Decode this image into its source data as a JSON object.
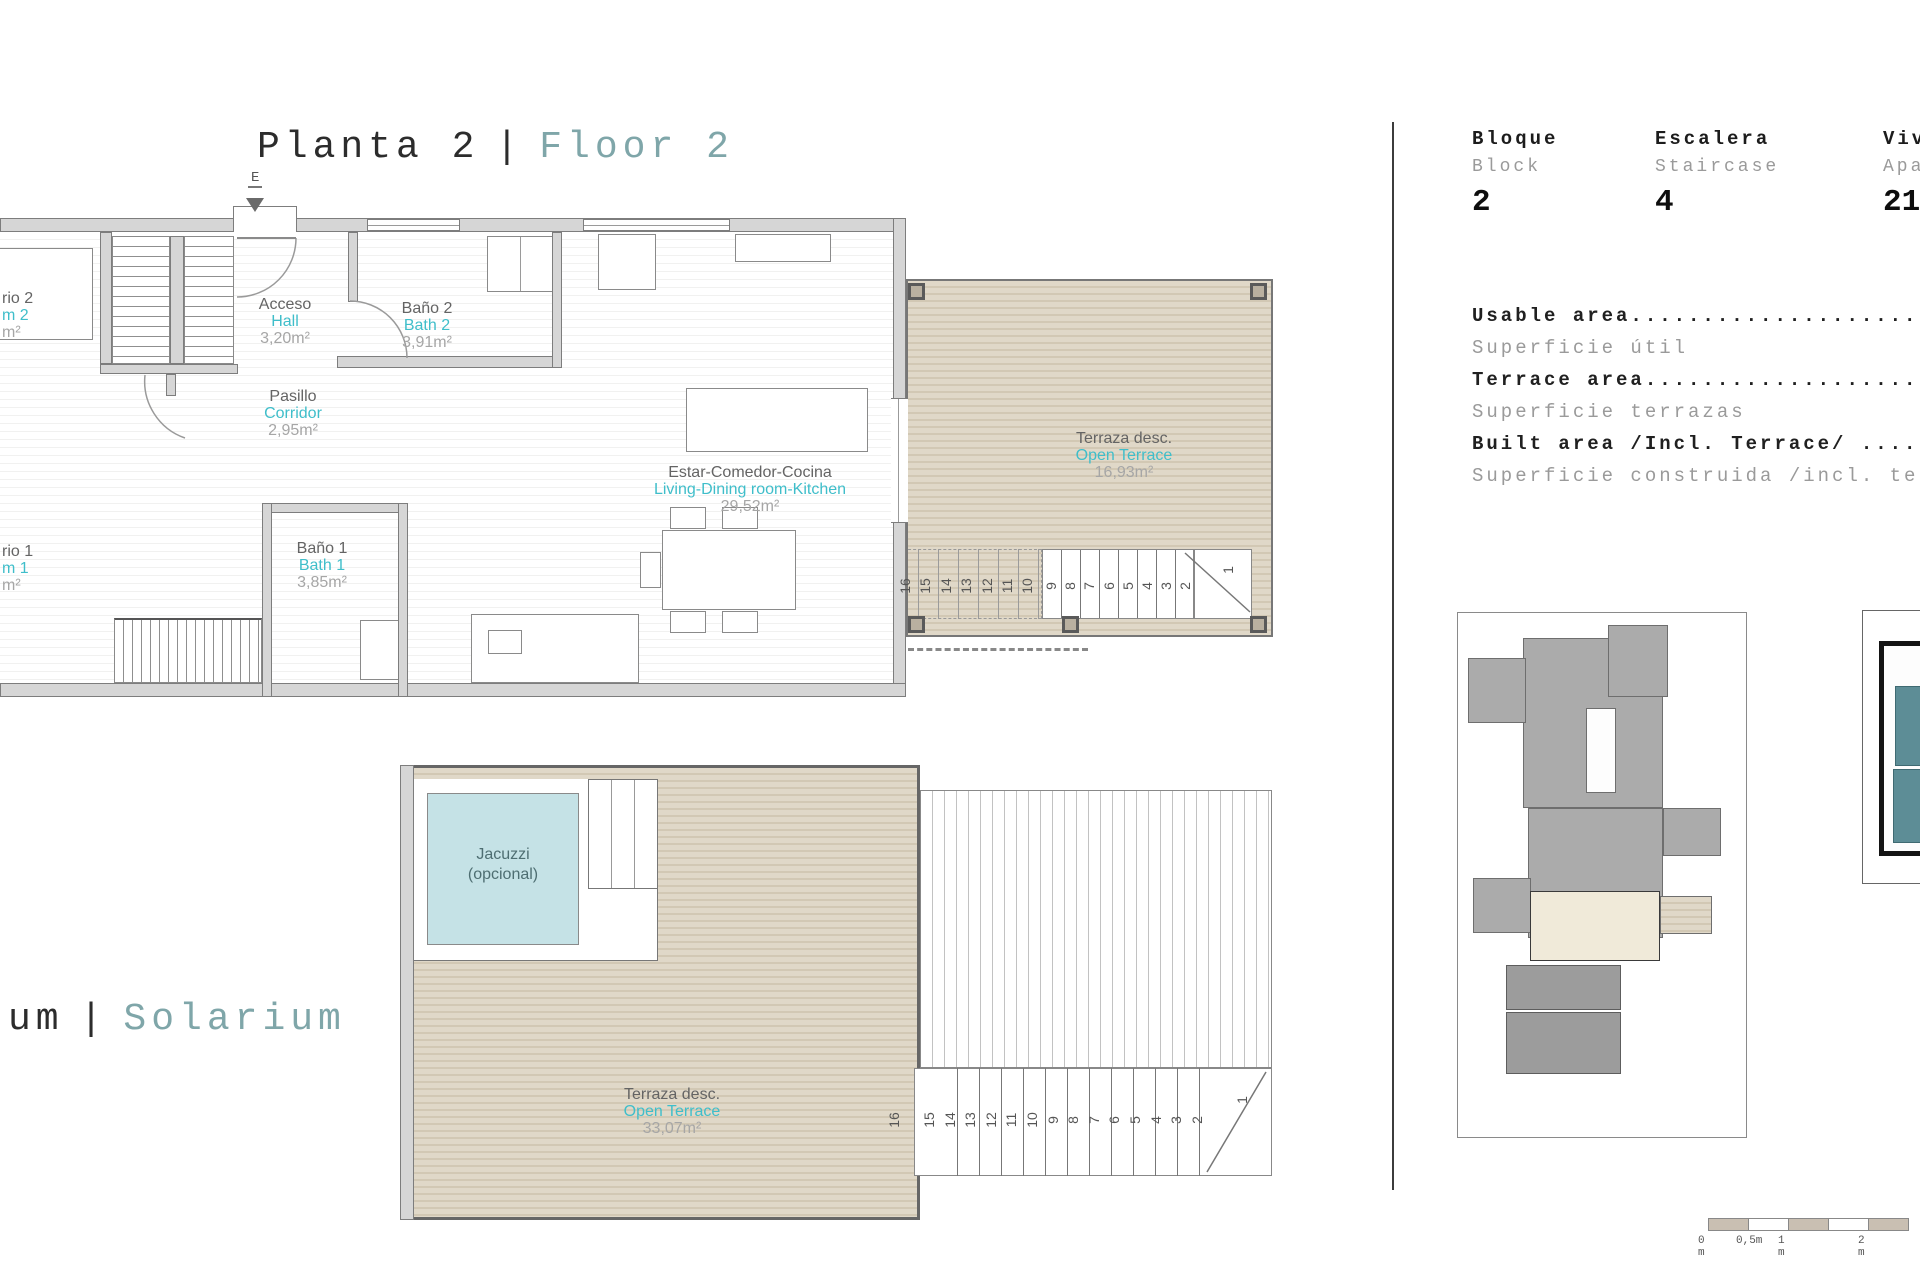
{
  "page": {
    "floor_title": {
      "es": "Planta 2",
      "sep": "|",
      "en": "Floor 2"
    },
    "solarium_title": {
      "es": "um",
      "sep": "|",
      "en": "Solarium"
    },
    "entry_marker": "E"
  },
  "rooms": {
    "bedroom2": {
      "es": "rio 2",
      "en": "m 2",
      "area": "m²"
    },
    "hall": {
      "es": "Acceso",
      "en": "Hall",
      "area": "3,20m²"
    },
    "bath2": {
      "es": "Baño 2",
      "en": "Bath 2",
      "area": "3,91m²"
    },
    "corridor": {
      "es": "Pasillo",
      "en": "Corridor",
      "area": "2,95m²"
    },
    "bath1": {
      "es": "Baño 1",
      "en": "Bath 1",
      "area": "3,85m²"
    },
    "bedroom1": {
      "es": "rio 1",
      "en": "m 1",
      "area": "m²"
    },
    "living": {
      "es": "Estar-Comedor-Cocina",
      "en": "Living-Dining room-Kitchen",
      "area": "29,52m²"
    },
    "terrace_top": {
      "es": "Terraza desc.",
      "en": "Open Terrace",
      "area": "16,93m²"
    },
    "terrace_solarium": {
      "es": "Terraza desc.",
      "en": "Open Terrace",
      "area": "33,07m²"
    },
    "jacuzzi": {
      "line1": "Jacuzzi",
      "line2": "(opcional)"
    }
  },
  "info_panel": {
    "columns": [
      {
        "es": "Bloque",
        "en": "Block",
        "value": "2"
      },
      {
        "es": "Escalera",
        "en": "Staircase",
        "value": "4"
      },
      {
        "es": "Viv",
        "en": "Apa",
        "value": "21"
      }
    ],
    "areas": [
      {
        "en": "Usable area..........................",
        "es": "Superficie útil"
      },
      {
        "en": "Terrace area.........................",
        "es": "Superficie terrazas"
      },
      {
        "en": "Built area /Incl. Terrace/ ..........",
        "es": "Superficie construida /incl. te"
      }
    ]
  },
  "stairs": {
    "top": [
      "16",
      "15",
      "14",
      "13",
      "12",
      "11",
      "10",
      "9",
      "8",
      "7",
      "6",
      "5",
      "4",
      "3",
      "2",
      "1"
    ],
    "solarium": [
      "16",
      "15",
      "14",
      "13",
      "12",
      "11",
      "10",
      "9",
      "8",
      "7",
      "6",
      "5",
      "4",
      "3",
      "2",
      "1"
    ]
  },
  "scale_bar": {
    "labels": [
      "0 m",
      "0,5m",
      "1 m",
      "2 m"
    ]
  },
  "colors": {
    "accent_teal": "#3fbeca",
    "title_teal": "#7fa6a9",
    "decking_base": "#e0d8c8",
    "decking_stripe": "#d2c8b4",
    "jacuzzi_fill": "#c5e2e6",
    "wall_gray": "#d6d6d6"
  }
}
